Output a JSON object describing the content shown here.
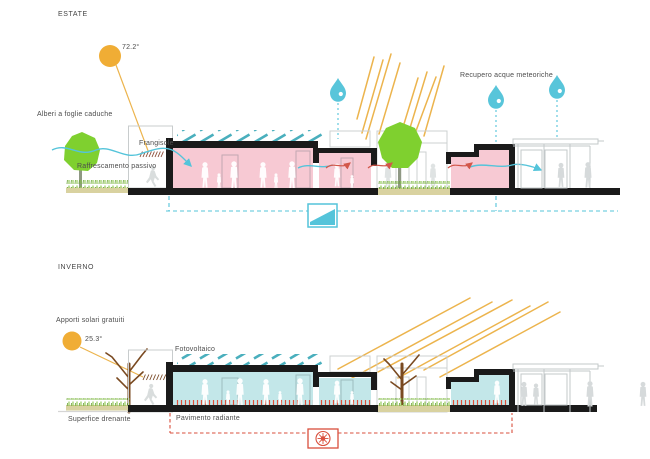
{
  "diagram": {
    "summer": {
      "title": "ESTATE",
      "sun_angle_label": "72.2°",
      "labels": {
        "deciduous_trees": "Alberi a foglie caduche",
        "brise_soleil": "Frangisole",
        "passive_cooling": "Raffrescamento passivo",
        "rainwater_recovery": "Recupero acque meteoriche"
      }
    },
    "winter": {
      "title": "INVERNO",
      "sun_angle_label": "25.3°",
      "labels": {
        "free_solar_gains": "Apporti solari gratuiti",
        "photovoltaic": "Fotovoltaico",
        "draining_surface": "Superfice drenante",
        "radiant_floor": "Pavimento radiante"
      }
    },
    "icons": {
      "sun": "sun-icon",
      "raindrop": "raindrop-icon",
      "water_tank": "water-tank-icon",
      "heat_pump_fan": "heat-pump-icon",
      "solar_panels": "solar-panels-icon"
    },
    "colors": {
      "pink_interior": "#f7c9d3",
      "cyan_interior": "#c3e7e9",
      "water_cyan": "#54c4da",
      "panel_teal": "#4aafbd",
      "sun_orange": "#f0ad35",
      "ray_yellow": "#ecb44d",
      "alert_red": "#d9503c",
      "tree_green": "#7fd02f",
      "trunk_brown": "#7a4a21",
      "grass_olive": "#d9d2a0",
      "outline_grey": "#c5c9cb",
      "section_black": "#1a1a1a",
      "text_grey": "#4d4d4d"
    }
  }
}
